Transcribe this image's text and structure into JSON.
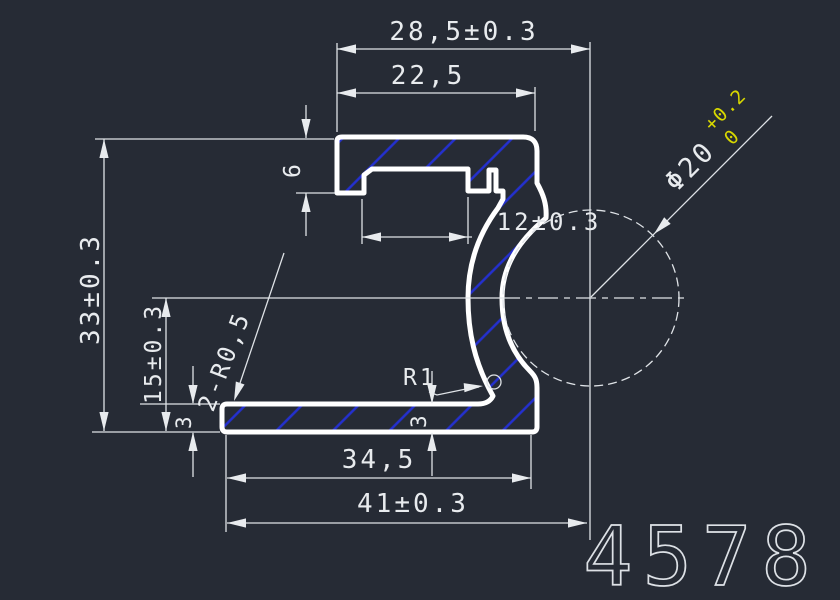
{
  "colors": {
    "background": "#262b35",
    "line": "#dfe3e7",
    "profile_outline": "#ffffff",
    "hatch": "#2430cf",
    "tolerance_text": "#d8d800",
    "part_number_text": "#dde1e6"
  },
  "dimensions": {
    "top_width_outer": "28,5±0.3",
    "top_width_inner": "22,5",
    "flange_height": "6",
    "channel_opening": "12±0.3",
    "overall_height": "33±0.3",
    "center_height": "15±0.3",
    "base_thickness_left": "3",
    "base_thickness_right": "3",
    "base_width_inner": "34,5",
    "base_width_overall": "41±0.3"
  },
  "callouts": {
    "corner_radius": "2-R0,5",
    "fillet_radius": "R1",
    "rod_diameter": "Φ20",
    "rod_tolerance_upper": "+0.2",
    "rod_tolerance_lower": "0"
  },
  "part_number": "4578"
}
